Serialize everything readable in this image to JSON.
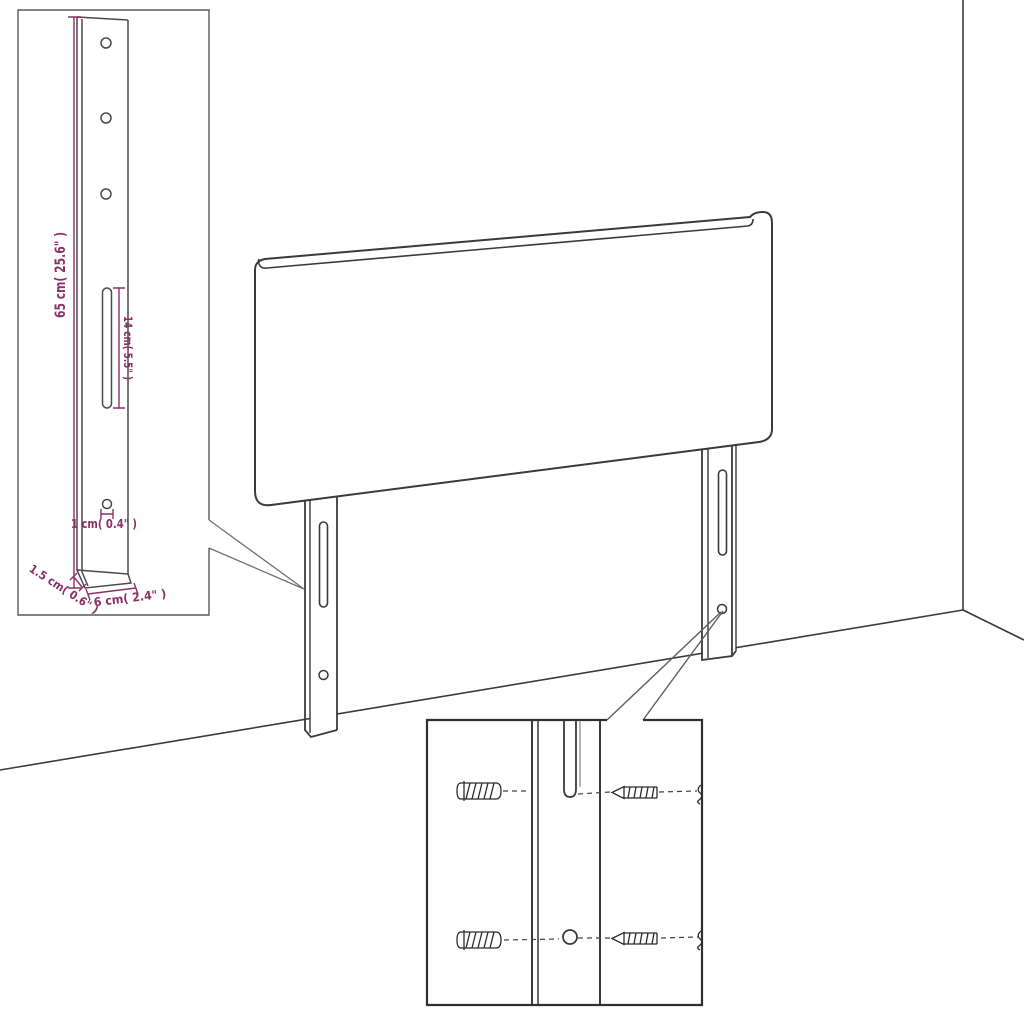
{
  "colors": {
    "line": "#3a3a3a",
    "dimension_accent": "#8b3066",
    "background": "#ffffff"
  },
  "leg_detail_inset": {
    "height_label": "65 cm( 25.6\" )",
    "slot_length_label": "14 cm( 5.5\" )",
    "hole_diameter_label": "1 cm( 0.4\" )",
    "thickness_label": "1.5 cm( 0.6\" )",
    "width_label": "6 cm( 2.4\" )"
  }
}
